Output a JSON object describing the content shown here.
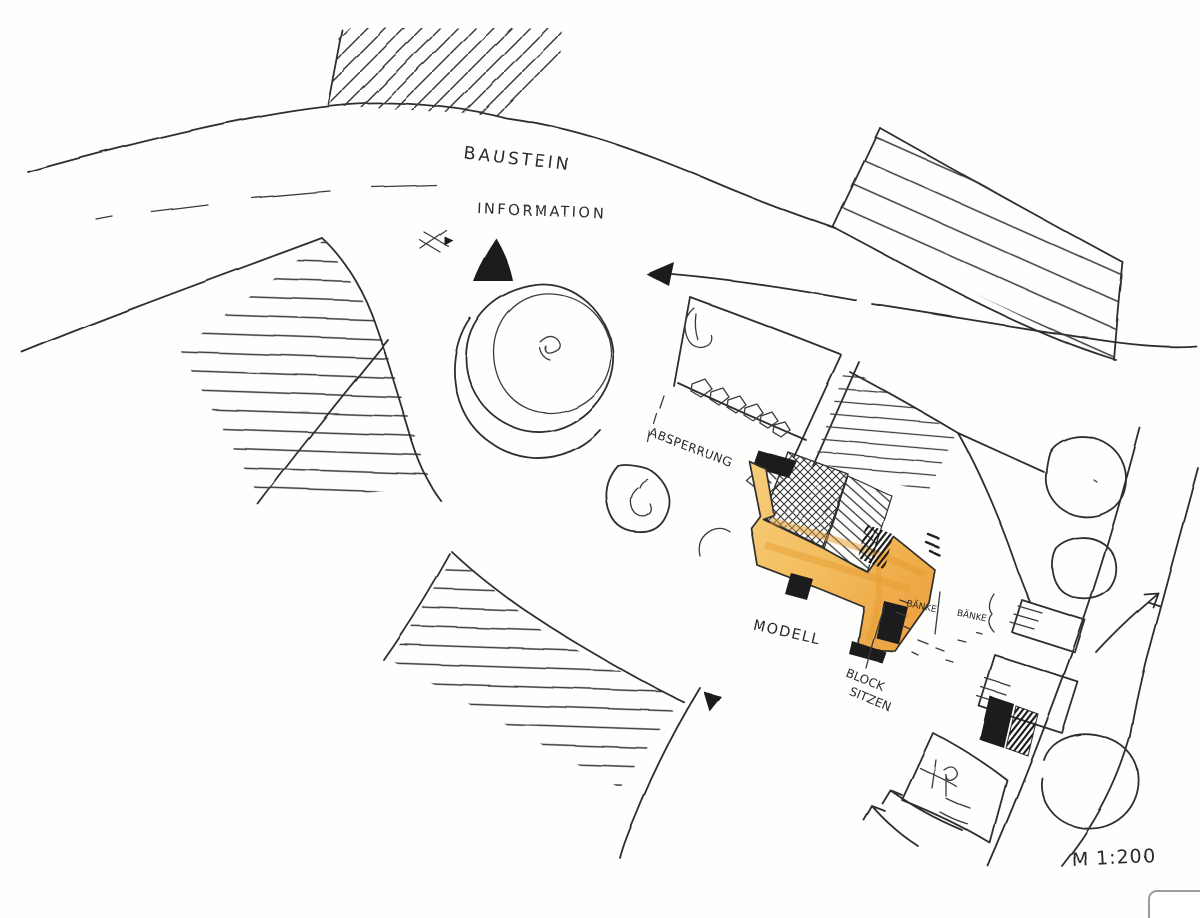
{
  "labels": {
    "baustein": "BAUSTEIN",
    "information": "INFORMATION",
    "absperrung": "ABSPERRUNG",
    "modell": "MODELL",
    "block_line1": "BLOCK",
    "block_line2": "SITZEN",
    "bench_note_left": "BÄNKE",
    "bench_note_right": "BÄNKE",
    "scale": "M 1:200"
  },
  "markers": {
    "information_marker": "filled-black-triangle",
    "flow_arrow": "left-pointing-arrow",
    "north_scribble": "sketch-arrow",
    "stair_arrow": "northeast-open-arrow"
  },
  "colors": {
    "ink": "#2e2e2e",
    "highlight": "#f5c469",
    "highlight_deep": "#e8a03a",
    "paper": "#fefefd"
  }
}
